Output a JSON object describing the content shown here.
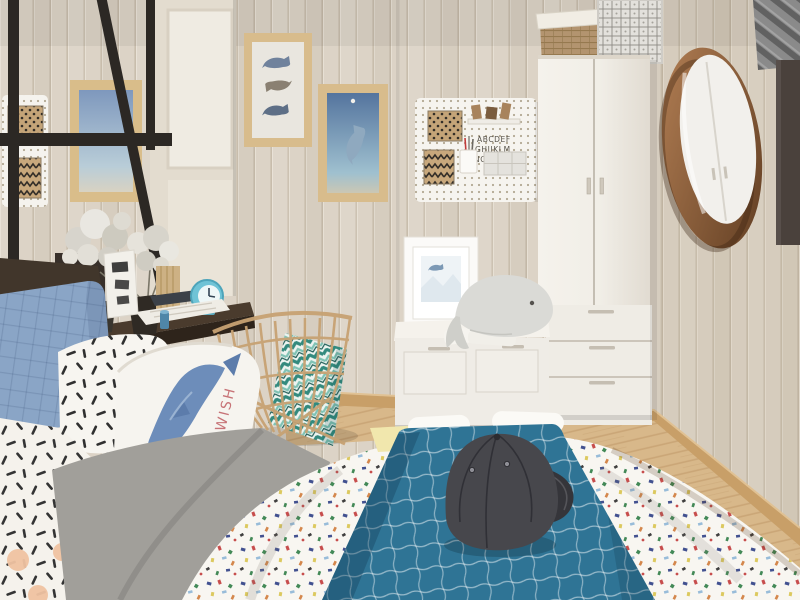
{
  "scene": {
    "title": "Scandinavian kids bedroom with whale decor",
    "texts": {
      "pegboard": {
        "line1": "ABCDEF",
        "line2": "GHIJKLM",
        "line3": "NOPQRST"
      },
      "whale_pillow": "MAKE A WISH"
    },
    "palette": {
      "wall": "#dcd3c6",
      "wall_groove": "#c8bdac",
      "floor": "#d8b88a",
      "baseboard": "#c89f68",
      "wardrobe_white": "#f3f0ea",
      "duvet_white": "#f8f6f1",
      "blanket_teal": "#2f7495",
      "pillow_blue": "#8aa5c6",
      "rattan": "#c7a273",
      "mirror_wood": "#9a6b42",
      "curtain_gray": "#7d7d7d",
      "window_dark": "#4a413c",
      "frame_wood": "#d8bc8c",
      "cap_gray": "#47474c",
      "desk_dark": "#3a2f26",
      "pillow_text_red": "#c2666b",
      "whale_art_blue": "#6d8dba"
    },
    "objects": [
      "black canopy bed frame",
      "white pegboard organizers",
      "whale art prints",
      "floating dark wood desk",
      "white flowers in vases",
      "teal alarm clock",
      "rattan wire chair",
      "chevron cushion",
      "storage bench",
      "whale plush",
      "white wardrobe",
      "stacked storage boxes",
      "round walnut mirror",
      "gray curtain",
      "terrazzo speckled duvet",
      "teal grid blanket",
      "dark baseball cap",
      "quilted blue pillow",
      "dash pattern pillows"
    ]
  }
}
